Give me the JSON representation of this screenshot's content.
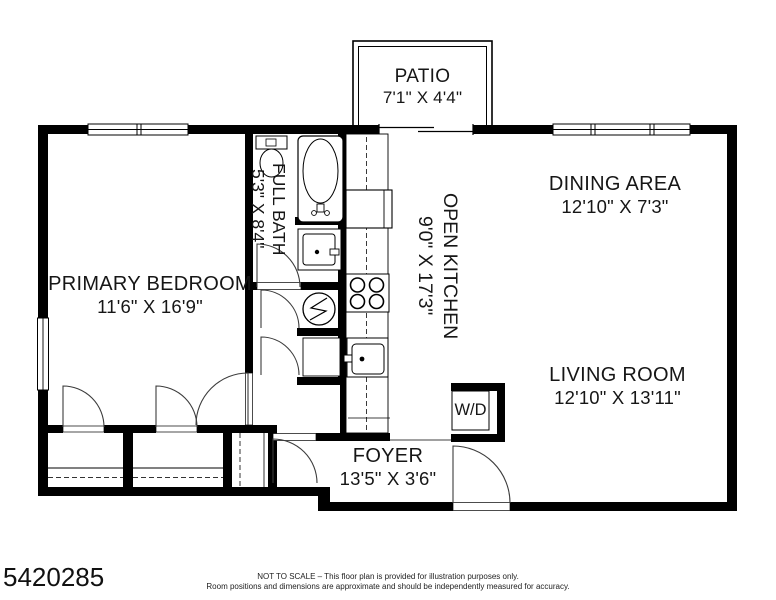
{
  "plan": {
    "rooms": {
      "patio": {
        "name": "PATIO",
        "dims": "7'1\" X 4'4\""
      },
      "dining": {
        "name": "DINING AREA",
        "dims": "12'10\" X 7'3\""
      },
      "kitchen": {
        "name": "OPEN KITCHEN",
        "dims": "9'0\" X 17'3\""
      },
      "bath": {
        "name": "FULL BATH",
        "dims": "5'3\" X 8'4\""
      },
      "bedroom": {
        "name": "PRIMARY BEDROOM",
        "dims": "11'6\" X 16'9\""
      },
      "living": {
        "name": "LIVING ROOM",
        "dims": "12'10\" X 13'11\""
      },
      "foyer": {
        "name": "FOYER",
        "dims": "13'5\" X 3'6\""
      }
    },
    "fixtures": {
      "washer_dryer_label": "W/D",
      "icons": [
        "bathtub-icon",
        "toilet-icon",
        "vanity-sink-icon",
        "refrigerator-icon",
        "stove-icon",
        "kitchen-sink-icon",
        "water-heater-icon",
        "door-swing-icon",
        "window-icon",
        "sliding-door-icon",
        "closet-rod-icon"
      ]
    },
    "colors": {
      "wall": "#000000",
      "background": "#ffffff",
      "text": "#161616"
    }
  },
  "footer": {
    "listing_id": "5420285",
    "disclaimer_line1": "NOT TO SCALE – This floor plan is provided for illustration purposes only.",
    "disclaimer_line2": "Room positions and dimensions are approximate and should be independently measured for accuracy."
  }
}
